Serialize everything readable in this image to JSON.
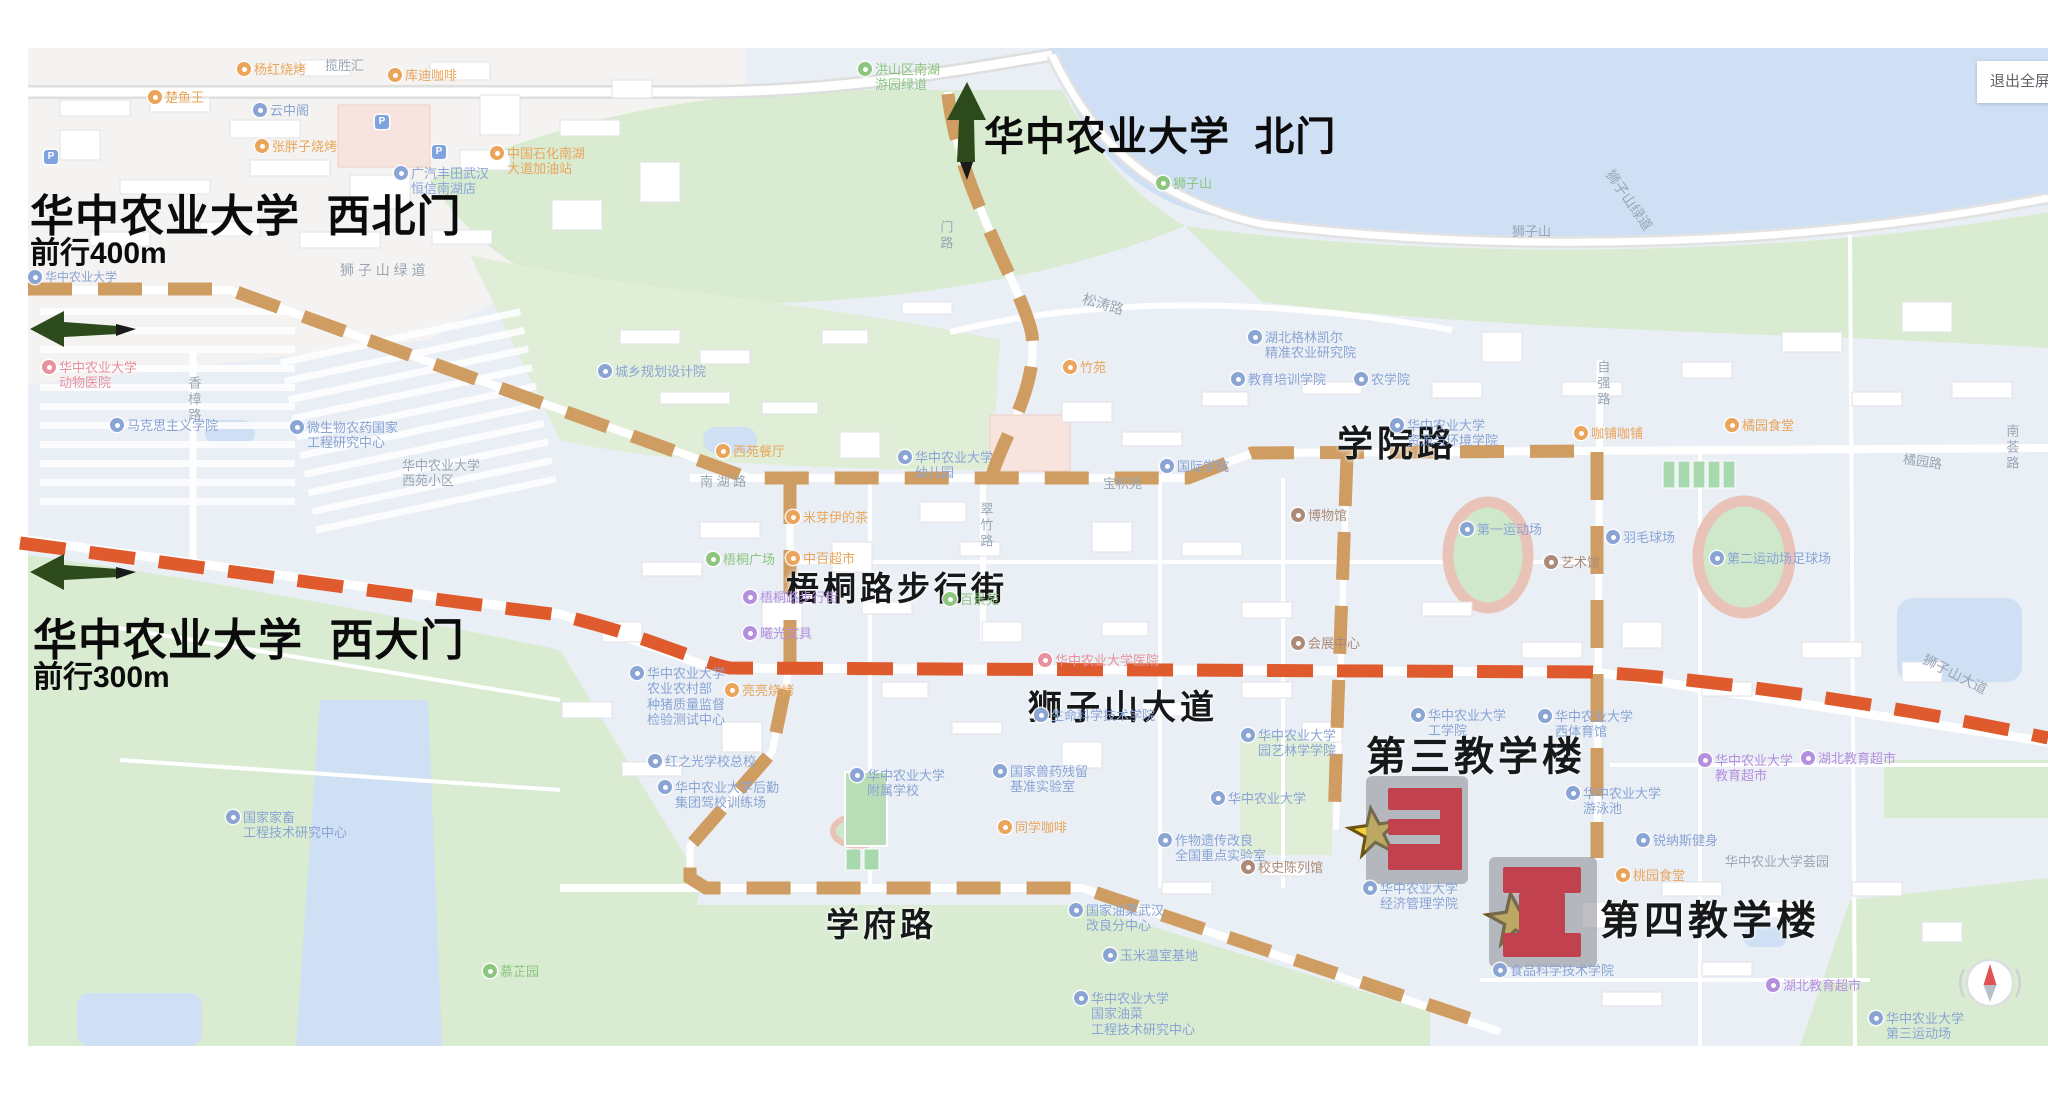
{
  "window": {
    "fullscreen_button_label": "退出全屏"
  },
  "annotations": {
    "north_gate": {
      "title": "华中农业大学  北门"
    },
    "northwest_gate": {
      "title": "华中农业大学  西北门",
      "subtitle": "前行400m"
    },
    "west_gate": {
      "title": "华中农业大学  西大门",
      "subtitle": "前行300m"
    },
    "building3_label": "第三教学楼",
    "building4_label": "第四教学楼"
  },
  "bold_road_labels": [
    {
      "text": "梧桐路步行街",
      "x": 786,
      "y": 562,
      "size": 33
    },
    {
      "text": "狮子山大道",
      "x": 1028,
      "y": 680,
      "size": 34
    },
    {
      "text": "学院路",
      "x": 1337,
      "y": 415,
      "size": 36
    },
    {
      "text": "学府路",
      "x": 826,
      "y": 898,
      "size": 33
    }
  ],
  "colors": {
    "route_tan": "#cf9c62",
    "route_red": "#df5b2e",
    "arrow_green": "#2d4a1c",
    "star_fill": "#f6d23e",
    "star_stroke": "#6b5310",
    "building_red": "#c2414f",
    "building_pad": "#97979d",
    "poi_blue": "#8aa4d4",
    "poi_orange": "#eaa55b",
    "poi_green": "#8cc57e",
    "poi_purple": "#b48fdd",
    "poi_pink": "#e8909c",
    "poi_gray": "#9aa6b4",
    "poi_brown": "#ab8a78",
    "water": "#cfe0f5",
    "green_area": "#d9ecd2",
    "urban_area": "#f4f3f1",
    "campus_area": "#e9eff5"
  },
  "pois": [
    {
      "x": 237,
      "y": 62,
      "c": "orange",
      "t": [
        "杨红烧烤"
      ]
    },
    {
      "x": 148,
      "y": 90,
      "c": "orange",
      "t": [
        "楚鱼王"
      ]
    },
    {
      "x": 253,
      "y": 103,
      "c": "blue",
      "t": [
        "云中阁"
      ]
    },
    {
      "x": 255,
      "y": 139,
      "c": "orange",
      "t": [
        "张胖子烧烤"
      ]
    },
    {
      "x": 388,
      "y": 68,
      "c": "orange",
      "t": [
        "库迪咖啡"
      ]
    },
    {
      "x": 325,
      "y": 58,
      "c": "gray",
      "t": [
        "揽胜汇"
      ],
      "ni": 1
    },
    {
      "x": 394,
      "y": 166,
      "c": "blue",
      "t": [
        "广汽丰田武汉",
        "恒信南湖店"
      ]
    },
    {
      "x": 490,
      "y": 146,
      "c": "orange",
      "t": [
        "中国石化南湖",
        "大道加油站"
      ]
    },
    {
      "x": 44,
      "y": 150,
      "c": "parking",
      "t": [
        "P"
      ]
    },
    {
      "x": 375,
      "y": 115,
      "c": "parking",
      "t": [
        "P"
      ]
    },
    {
      "x": 432,
      "y": 145,
      "c": "parking",
      "t": [
        "P"
      ]
    },
    {
      "x": 858,
      "y": 62,
      "c": "green",
      "t": [
        "洪山区南湖",
        "游园绿道"
      ]
    },
    {
      "x": 1156,
      "y": 176,
      "c": "green",
      "t": [
        "狮子山"
      ]
    },
    {
      "x": 340,
      "y": 262,
      "c": "gray",
      "t": [
        "狮 子 山 绿 道"
      ],
      "ni": 1,
      "fs": 14
    },
    {
      "x": 1594,
      "y": 192,
      "c": "gray",
      "t": [
        "狮子山绿道"
      ],
      "ni": 1,
      "r": 55,
      "fs": 14
    },
    {
      "x": 1512,
      "y": 224,
      "c": "gray",
      "t": [
        "狮子山"
      ],
      "ni": 1
    },
    {
      "x": 28,
      "y": 270,
      "c": "blue",
      "t": [
        "华中农业大学"
      ],
      "fs": 12
    },
    {
      "x": 42,
      "y": 360,
      "c": "pink",
      "t": [
        "华中农业大学",
        "动物医院"
      ]
    },
    {
      "x": 186,
      "y": 376,
      "c": "gray",
      "t": [
        "香樟路"
      ],
      "ni": 1,
      "v": 1
    },
    {
      "x": 598,
      "y": 364,
      "c": "blue",
      "t": [
        "城乡规划设计院"
      ]
    },
    {
      "x": 110,
      "y": 418,
      "c": "blue",
      "t": [
        "马克思主义学院"
      ]
    },
    {
      "x": 290,
      "y": 420,
      "c": "blue",
      "t": [
        "微生物农药国家",
        "工程研究中心"
      ]
    },
    {
      "x": 402,
      "y": 458,
      "c": "gray",
      "t": [
        "华中农业大学",
        "西苑小区"
      ],
      "ni": 1
    },
    {
      "x": 700,
      "y": 474,
      "c": "gray",
      "t": [
        "南 湖 路"
      ],
      "ni": 1
    },
    {
      "x": 716,
      "y": 444,
      "c": "orange",
      "t": [
        "西苑餐厅"
      ]
    },
    {
      "x": 898,
      "y": 450,
      "c": "blue",
      "t": [
        "华中农业大学",
        "幼儿园"
      ]
    },
    {
      "x": 786,
      "y": 510,
      "c": "orange",
      "t": [
        "米芽伊的茶"
      ]
    },
    {
      "x": 706,
      "y": 552,
      "c": "green",
      "t": [
        "梧桐广场"
      ]
    },
    {
      "x": 786,
      "y": 551,
      "c": "orange",
      "t": [
        "中百超市"
      ]
    },
    {
      "x": 743,
      "y": 590,
      "c": "purple",
      "t": [
        "梧桐路步行街"
      ]
    },
    {
      "x": 743,
      "y": 626,
      "c": "purple",
      "t": [
        "曦光文具"
      ]
    },
    {
      "x": 943,
      "y": 592,
      "c": "green",
      "t": [
        "百景苑"
      ]
    },
    {
      "x": 978,
      "y": 502,
      "c": "gray",
      "t": [
        "翠竹路"
      ],
      "ni": 1,
      "v": 1
    },
    {
      "x": 1063,
      "y": 360,
      "c": "orange",
      "t": [
        "竹苑"
      ]
    },
    {
      "x": 1082,
      "y": 296,
      "c": "gray",
      "t": [
        "松涛路"
      ],
      "ni": 1,
      "r": 16,
      "fs": 14
    },
    {
      "x": 1248,
      "y": 330,
      "c": "blue",
      "t": [
        "湖北格林凯尔",
        "精准农业研究院"
      ]
    },
    {
      "x": 1231,
      "y": 372,
      "c": "blue",
      "t": [
        "教育培训学院"
      ]
    },
    {
      "x": 1354,
      "y": 372,
      "c": "blue",
      "t": [
        "农学院"
      ]
    },
    {
      "x": 1390,
      "y": 418,
      "c": "blue",
      "t": [
        "华中农业大学",
        "资源与环境学院"
      ]
    },
    {
      "x": 938,
      "y": 220,
      "c": "gray",
      "t": [
        "门路"
      ],
      "ni": 1,
      "v": 1
    },
    {
      "x": 1291,
      "y": 508,
      "c": "brown",
      "t": [
        "博物馆"
      ]
    },
    {
      "x": 1103,
      "y": 476,
      "c": "gray",
      "t": [
        "宝积苑"
      ],
      "ni": 1
    },
    {
      "x": 1160,
      "y": 459,
      "c": "blue",
      "t": [
        "国际学院"
      ]
    },
    {
      "x": 1460,
      "y": 522,
      "c": "blue",
      "t": [
        "第一运动场"
      ]
    },
    {
      "x": 1606,
      "y": 530,
      "c": "blue",
      "t": [
        "羽毛球场"
      ]
    },
    {
      "x": 1544,
      "y": 555,
      "c": "brown",
      "t": [
        "艺术馆"
      ]
    },
    {
      "x": 1710,
      "y": 551,
      "c": "blue",
      "t": [
        "第二运动场足球场"
      ]
    },
    {
      "x": 1595,
      "y": 360,
      "c": "gray",
      "t": [
        "自强路"
      ],
      "ni": 1,
      "v": 1
    },
    {
      "x": 1574,
      "y": 426,
      "c": "orange",
      "t": [
        "咖铺咖铺"
      ]
    },
    {
      "x": 1725,
      "y": 418,
      "c": "orange",
      "t": [
        "橘园食堂"
      ]
    },
    {
      "x": 1903,
      "y": 454,
      "c": "gray",
      "t": [
        "橘园路"
      ],
      "ni": 1,
      "r": 8
    },
    {
      "x": 2004,
      "y": 424,
      "c": "gray",
      "t": [
        "南荟路"
      ],
      "ni": 1,
      "v": 1
    },
    {
      "x": 1038,
      "y": 653,
      "c": "pink",
      "t": [
        "华中农业大学医院"
      ]
    },
    {
      "x": 1034,
      "y": 708,
      "c": "blue",
      "t": [
        "生命科学技术学院"
      ]
    },
    {
      "x": 1291,
      "y": 636,
      "c": "brown",
      "t": [
        "会展中心"
      ]
    },
    {
      "x": 1241,
      "y": 728,
      "c": "blue",
      "t": [
        "华中农业大学",
        "园艺林学学院"
      ]
    },
    {
      "x": 1211,
      "y": 791,
      "c": "blue",
      "t": [
        "华中农业大学"
      ]
    },
    {
      "x": 1158,
      "y": 833,
      "c": "blue",
      "t": [
        "作物遗传改良",
        "全国重点实验室"
      ]
    },
    {
      "x": 1241,
      "y": 860,
      "c": "brown",
      "t": [
        "校史陈列馆"
      ]
    },
    {
      "x": 993,
      "y": 764,
      "c": "blue",
      "t": [
        "国家兽药残留",
        "基准实验室"
      ]
    },
    {
      "x": 998,
      "y": 820,
      "c": "orange",
      "t": [
        "同学咖啡"
      ]
    },
    {
      "x": 648,
      "y": 754,
      "c": "blue",
      "t": [
        "红之光学校总校"
      ]
    },
    {
      "x": 658,
      "y": 780,
      "c": "blue",
      "t": [
        "华中农业大学后勤",
        "集团驾校训练场"
      ]
    },
    {
      "x": 630,
      "y": 666,
      "c": "blue",
      "t": [
        "华中农业大学",
        "农业农村部",
        "种猪质量监督",
        "检验测试中心"
      ]
    },
    {
      "x": 725,
      "y": 683,
      "c": "orange",
      "t": [
        "亮亮烧烤"
      ]
    },
    {
      "x": 850,
      "y": 768,
      "c": "blue",
      "t": [
        "华中农业大学",
        "附属学校"
      ]
    },
    {
      "x": 1069,
      "y": 903,
      "c": "blue",
      "t": [
        "国家油菜武汉",
        "改良分中心"
      ]
    },
    {
      "x": 1103,
      "y": 948,
      "c": "blue",
      "t": [
        "玉米温室基地"
      ]
    },
    {
      "x": 1074,
      "y": 991,
      "c": "blue",
      "t": [
        "华中农业大学",
        "国家油菜",
        "工程技术研究中心"
      ]
    },
    {
      "x": 226,
      "y": 810,
      "c": "blue",
      "t": [
        "国家家畜",
        "工程技术研究中心"
      ]
    },
    {
      "x": 483,
      "y": 964,
      "c": "green",
      "t": [
        "慕芷园"
      ]
    },
    {
      "x": 1411,
      "y": 708,
      "c": "blue",
      "t": [
        "华中农业大学",
        "工学院"
      ]
    },
    {
      "x": 1538,
      "y": 709,
      "c": "blue",
      "t": [
        "华中农业大学",
        "西体育馆"
      ]
    },
    {
      "x": 1566,
      "y": 786,
      "c": "blue",
      "t": [
        "华中农业大学",
        "游泳池"
      ]
    },
    {
      "x": 1636,
      "y": 833,
      "c": "blue",
      "t": [
        "锐纳斯健身"
      ]
    },
    {
      "x": 1616,
      "y": 868,
      "c": "orange",
      "t": [
        "桃园食堂"
      ]
    },
    {
      "x": 1698,
      "y": 753,
      "c": "purple",
      "t": [
        "华中农业大学",
        "教育超市"
      ]
    },
    {
      "x": 1801,
      "y": 751,
      "c": "purple",
      "t": [
        "湖北教育超市"
      ]
    },
    {
      "x": 1725,
      "y": 854,
      "c": "gray",
      "t": [
        "华中农业大学荟园"
      ],
      "ni": 1
    },
    {
      "x": 1363,
      "y": 881,
      "c": "blue",
      "t": [
        "华中农业大学",
        "经济管理学院"
      ]
    },
    {
      "x": 1493,
      "y": 963,
      "c": "blue",
      "t": [
        "食品科学技术学院"
      ]
    },
    {
      "x": 1766,
      "y": 978,
      "c": "purple",
      "t": [
        "湖北教育超市"
      ]
    },
    {
      "x": 1869,
      "y": 1011,
      "c": "blue",
      "t": [
        "华中农业大学",
        "第三运动场"
      ]
    },
    {
      "x": 1920,
      "y": 666,
      "c": "gray",
      "t": [
        "狮子山大道"
      ],
      "ni": 1,
      "r": 27,
      "fs": 14
    }
  ]
}
